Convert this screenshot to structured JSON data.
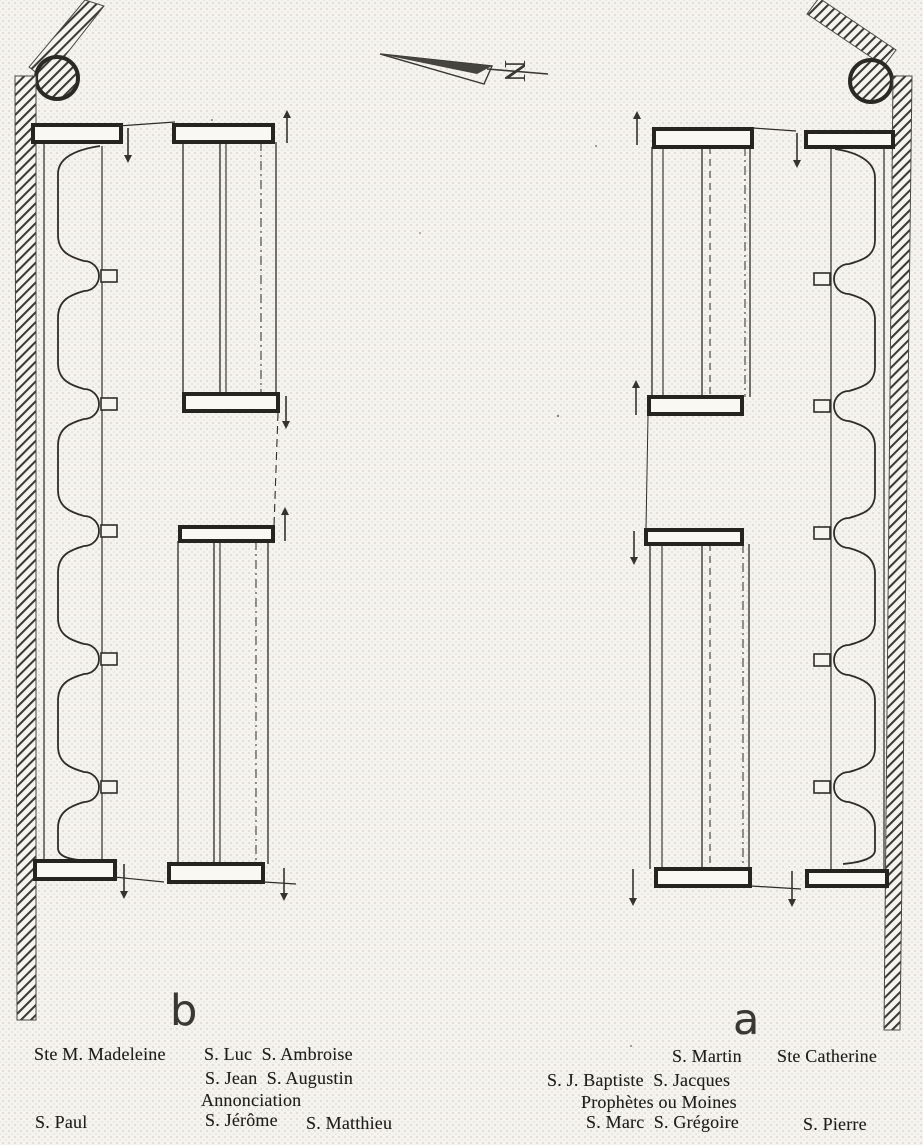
{
  "figure": {
    "kind": "scanned floor plan of choir stalls",
    "north_label": "N"
  },
  "sections": {
    "left_label": "b",
    "right_label": "a"
  },
  "captions": {
    "left": {
      "madeleine": "Ste M. Madeleine",
      "luc_ambroise": "S. Luc  S. Ambroise",
      "jean_augustin": "S. Jean  S. Augustin",
      "annonciation": "Annonciation",
      "paul": "S. Paul",
      "jerome": "S. Jérôme",
      "matthieu": "S. Matthieu"
    },
    "right": {
      "martin": "S. Martin",
      "catherine": "Ste Catherine",
      "baptiste_jacques": "S. J. Baptiste  S. Jacques",
      "prophetes": "Prophètes ou Moines",
      "marc_gregoire": "S. Marc  S. Grégoire",
      "pierre": "S. Pierre"
    }
  },
  "colors": {
    "ink": "#2f2d29",
    "paper": "#f6f4ef"
  }
}
